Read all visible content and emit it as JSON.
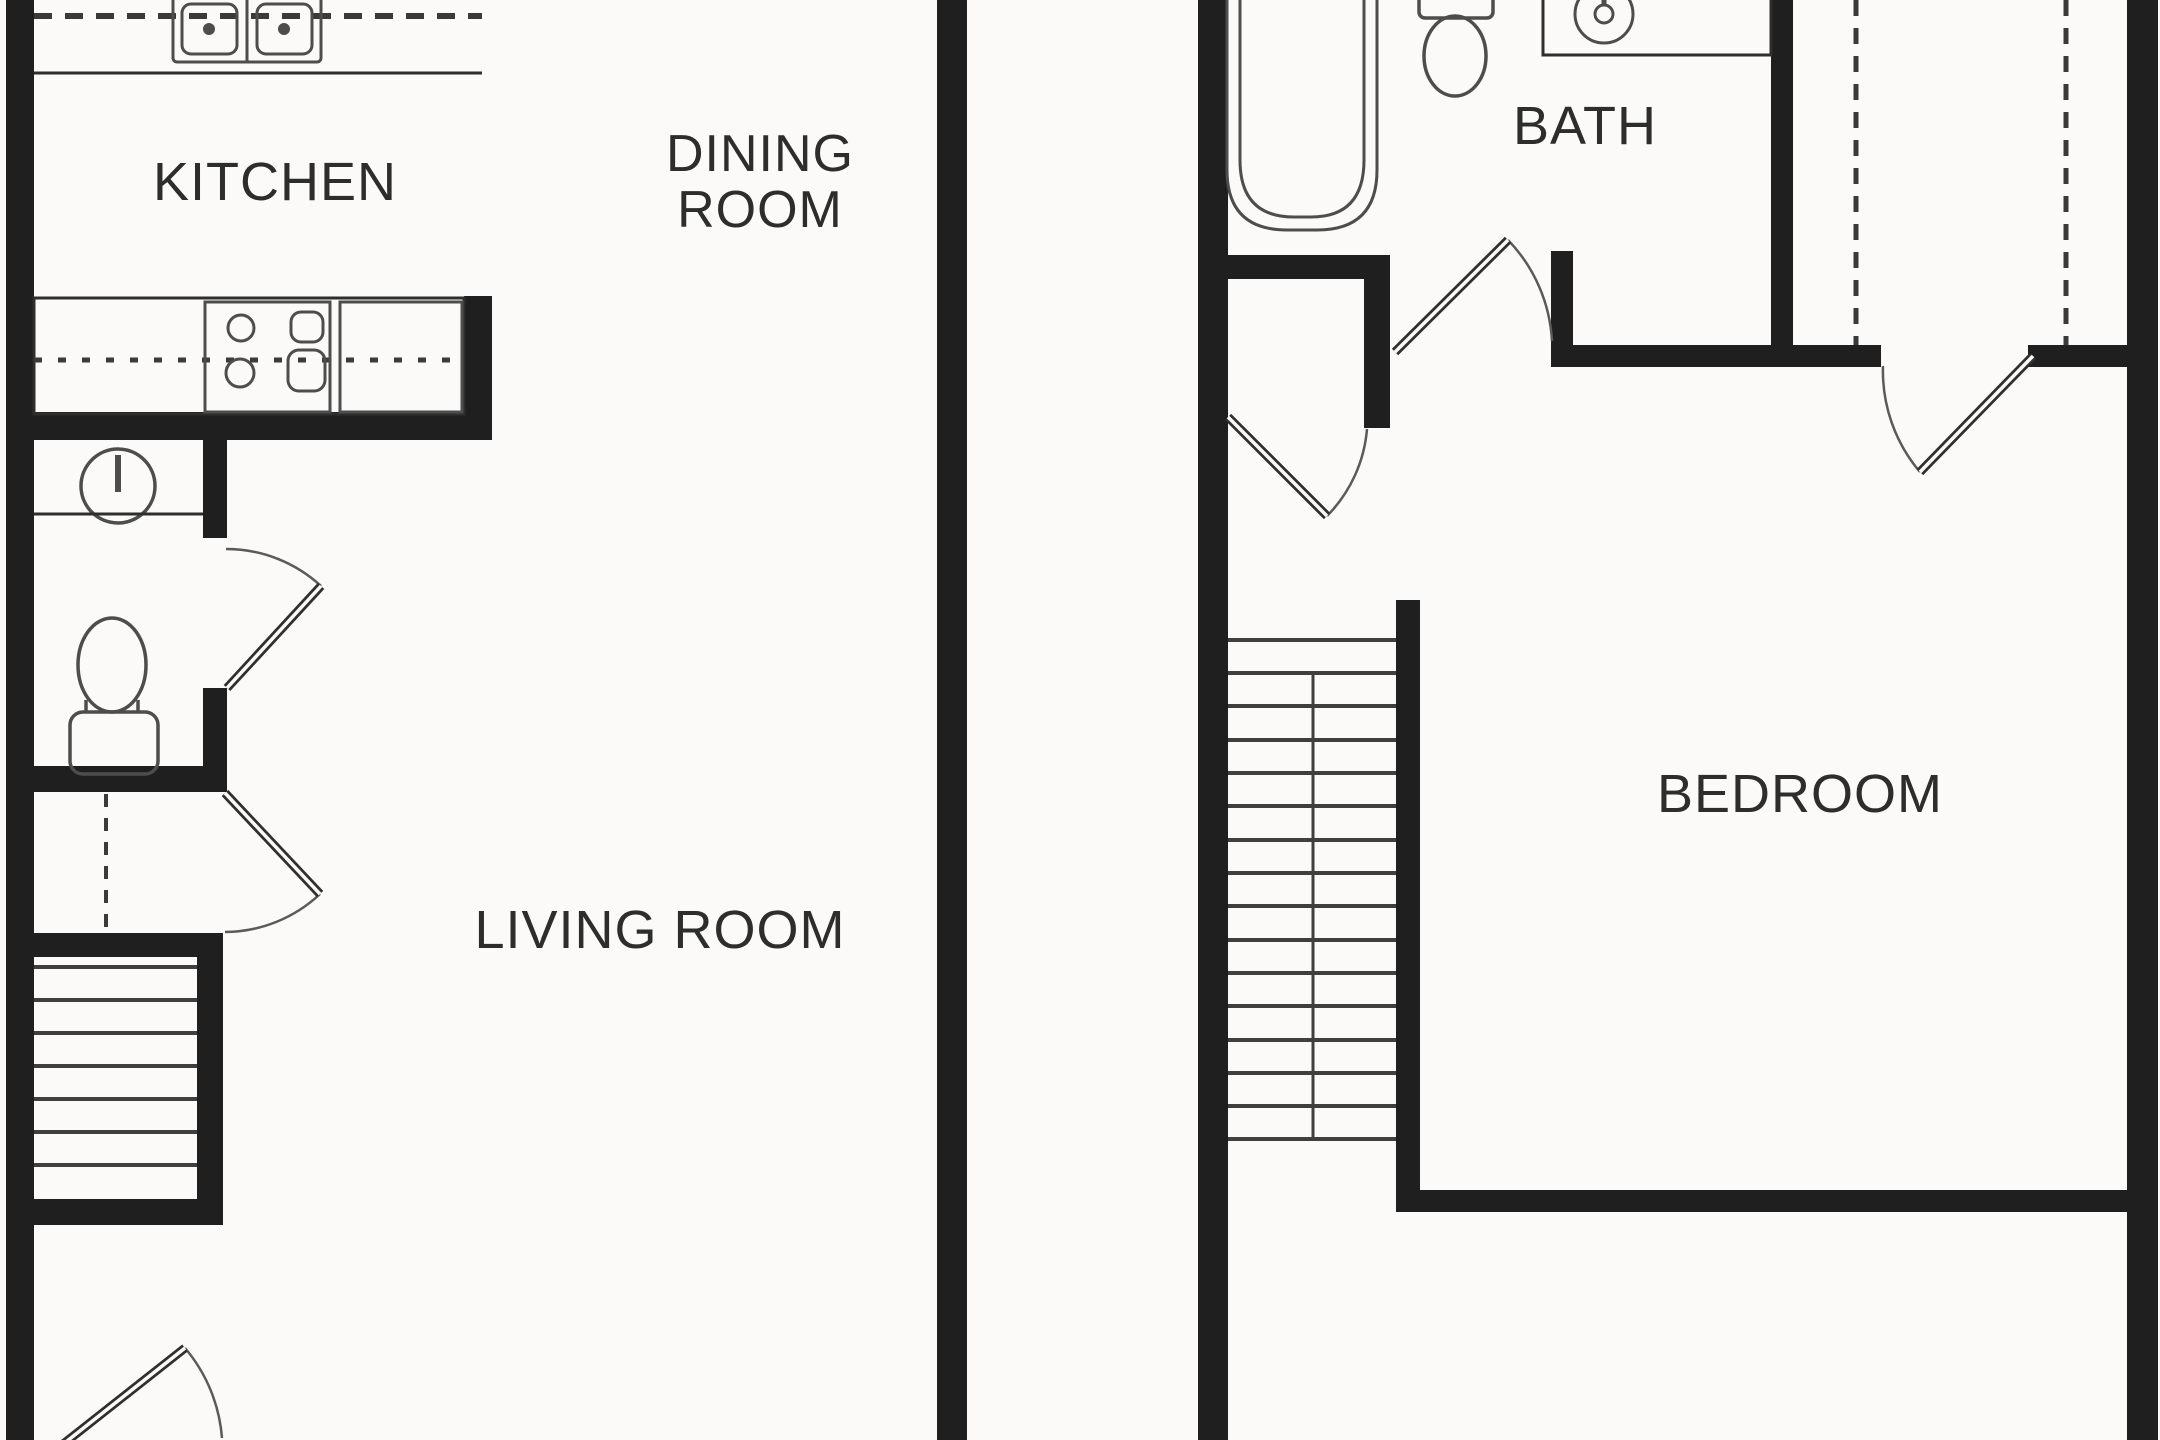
{
  "title": "Townhouse floor plan — two levels",
  "colors": {
    "background": "#fbfaf8",
    "wall": "#1f1f1f",
    "structure_line": "#2e2e2e",
    "fixture_line": "#4d4d4d",
    "arc_line": "#5a5a5a",
    "label_text": "#2d2d2d"
  },
  "labels": {
    "kitchen": "KITCHEN",
    "dining_room": [
      "DINING",
      "ROOM"
    ],
    "bath": "BATH",
    "living_room": "LIVING ROOM",
    "bedroom": "BEDROOM"
  },
  "fixtures": {
    "lower_level": [
      "double-sink",
      "upper-cabinets-dashed",
      "range-stove",
      "dishwasher-cabinet",
      "round-vanity-sink",
      "toilet",
      "under-stair-closet-dashed",
      "stairs",
      "entry-door"
    ],
    "upper_level": [
      "bathtub",
      "toilet",
      "vanity-sink",
      "linen-closet",
      "bedroom-closet-dashed",
      "stairs"
    ]
  }
}
